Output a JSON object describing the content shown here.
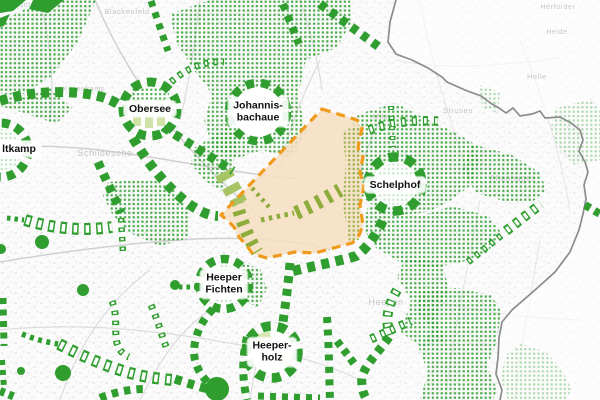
{
  "map": {
    "description": "green-network planning map with highlighted focus area",
    "region_labels": [
      {
        "id": "ltkamp",
        "lines": [
          "ltkamp"
        ],
        "x": 19,
        "y": 149
      },
      {
        "id": "obersee",
        "lines": [
          "Obersee"
        ],
        "x": 150,
        "y": 109
      },
      {
        "id": "johannisbachaue",
        "lines": [
          "Johannis-",
          "bachaue"
        ],
        "x": 258,
        "y": 112
      },
      {
        "id": "schelphof",
        "lines": [
          "Schelphof"
        ],
        "x": 395,
        "y": 185
      },
      {
        "id": "heeper-fichten",
        "lines": [
          "Heeper",
          "Fichten"
        ],
        "x": 224,
        "y": 284
      },
      {
        "id": "heeperholz",
        "lines": [
          "Heeper-",
          "holz"
        ],
        "x": 272,
        "y": 352
      }
    ],
    "background_labels": [
      {
        "text": "sendorf",
        "x": 20,
        "y": 7,
        "size": 7
      },
      {
        "text": "Blackenfeld",
        "x": 127,
        "y": 14,
        "size": 7.5
      },
      {
        "text": "Kusenkamp",
        "x": 84,
        "y": 91,
        "size": 7
      },
      {
        "text": "Schildesche",
        "x": 105,
        "y": 156,
        "size": 9
      },
      {
        "text": "Milse",
        "x": 383,
        "y": 119,
        "size": 7.5
      },
      {
        "text": "Strusen",
        "x": 458,
        "y": 113,
        "size": 7.5
      },
      {
        "text": "Herforder",
        "x": 558,
        "y": 9,
        "size": 7
      },
      {
        "text": "Heide",
        "x": 557,
        "y": 34,
        "size": 7
      },
      {
        "text": "Helle",
        "x": 537,
        "y": 79,
        "size": 7.5
      },
      {
        "text": "Altenhagen",
        "x": 513,
        "y": 181,
        "size": 8
      },
      {
        "text": "Heepen",
        "x": 386,
        "y": 305,
        "size": 9
      }
    ],
    "focus_area": {
      "style": "orange-dashed-outline",
      "fill": "tan"
    }
  },
  "colors": {
    "green": "#2f9e2f",
    "olive": "#8dac3c",
    "lightgreen": "#cfe3a8",
    "palepatch": "#a6c464",
    "orange": "#f09a1c",
    "tan": "#f5dfc1",
    "boundary": "#8c8c8c",
    "street": "#dadada",
    "bglabel": "#c6c6c6",
    "labeltext": "#111111",
    "paper": "#fbfbfb"
  }
}
